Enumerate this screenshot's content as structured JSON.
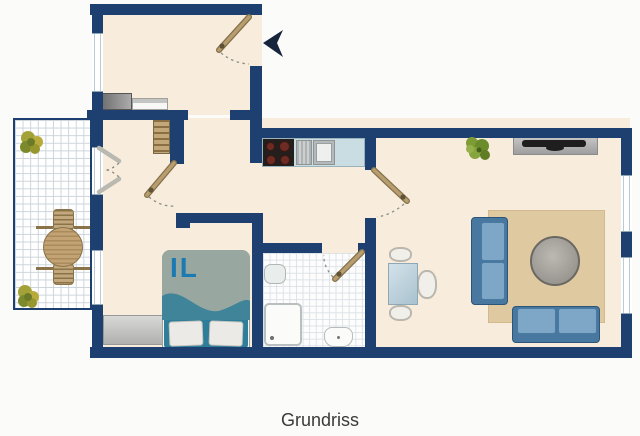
{
  "caption": "Grundriss",
  "bed": {
    "monogram": "IL"
  },
  "palette": {
    "wall": "#1d4070",
    "floor": "#f8eddc",
    "outside": "#fbfbf9",
    "balcony_grid": "#ccd4da",
    "bath_grid": "#dde2e6",
    "rug": "#dfc9a1",
    "sofa_cushion": "#7ea6c6",
    "sofa_frame": "#48779f",
    "coffee_table_gray": "#a5a29c",
    "dining_table": "#bfd3dd",
    "kitchen_counter": "#c9dde2",
    "stove": "#241f1c",
    "door_wood": "#b79d6f",
    "bed_duvet": "#99a7a1",
    "bed_wave": "#3f8499",
    "monogram_color": "#1c7ab2",
    "entrance_arrow": "#16243c",
    "caption_color": "#3a3a3a"
  },
  "rooms": {
    "entry": {
      "items": [
        "front-door",
        "entrance-arrow",
        "window",
        "wardrobe",
        "sideboard"
      ]
    },
    "hallway": {
      "items": [
        "shelf",
        "hallway-door",
        "balcony-french-door"
      ]
    },
    "balcony": {
      "items": [
        "plant",
        "plant",
        "garden-table",
        "garden-chair",
        "garden-chair"
      ]
    },
    "kitchen": {
      "items": [
        "countertop",
        "cooktop",
        "sink"
      ]
    },
    "bedroom": {
      "items": [
        "double-bed",
        "dresser",
        "window"
      ]
    },
    "bathroom": {
      "items": [
        "bathroom-door",
        "washbasin",
        "shower",
        "toilet"
      ]
    },
    "living_room": {
      "items": [
        "living-door",
        "plant",
        "tv-sideboard",
        "tv",
        "dining-table",
        "dining-chair",
        "dining-chair",
        "dining-chair",
        "rug",
        "sofa",
        "sofa",
        "coffee-table",
        "window",
        "window"
      ]
    }
  }
}
